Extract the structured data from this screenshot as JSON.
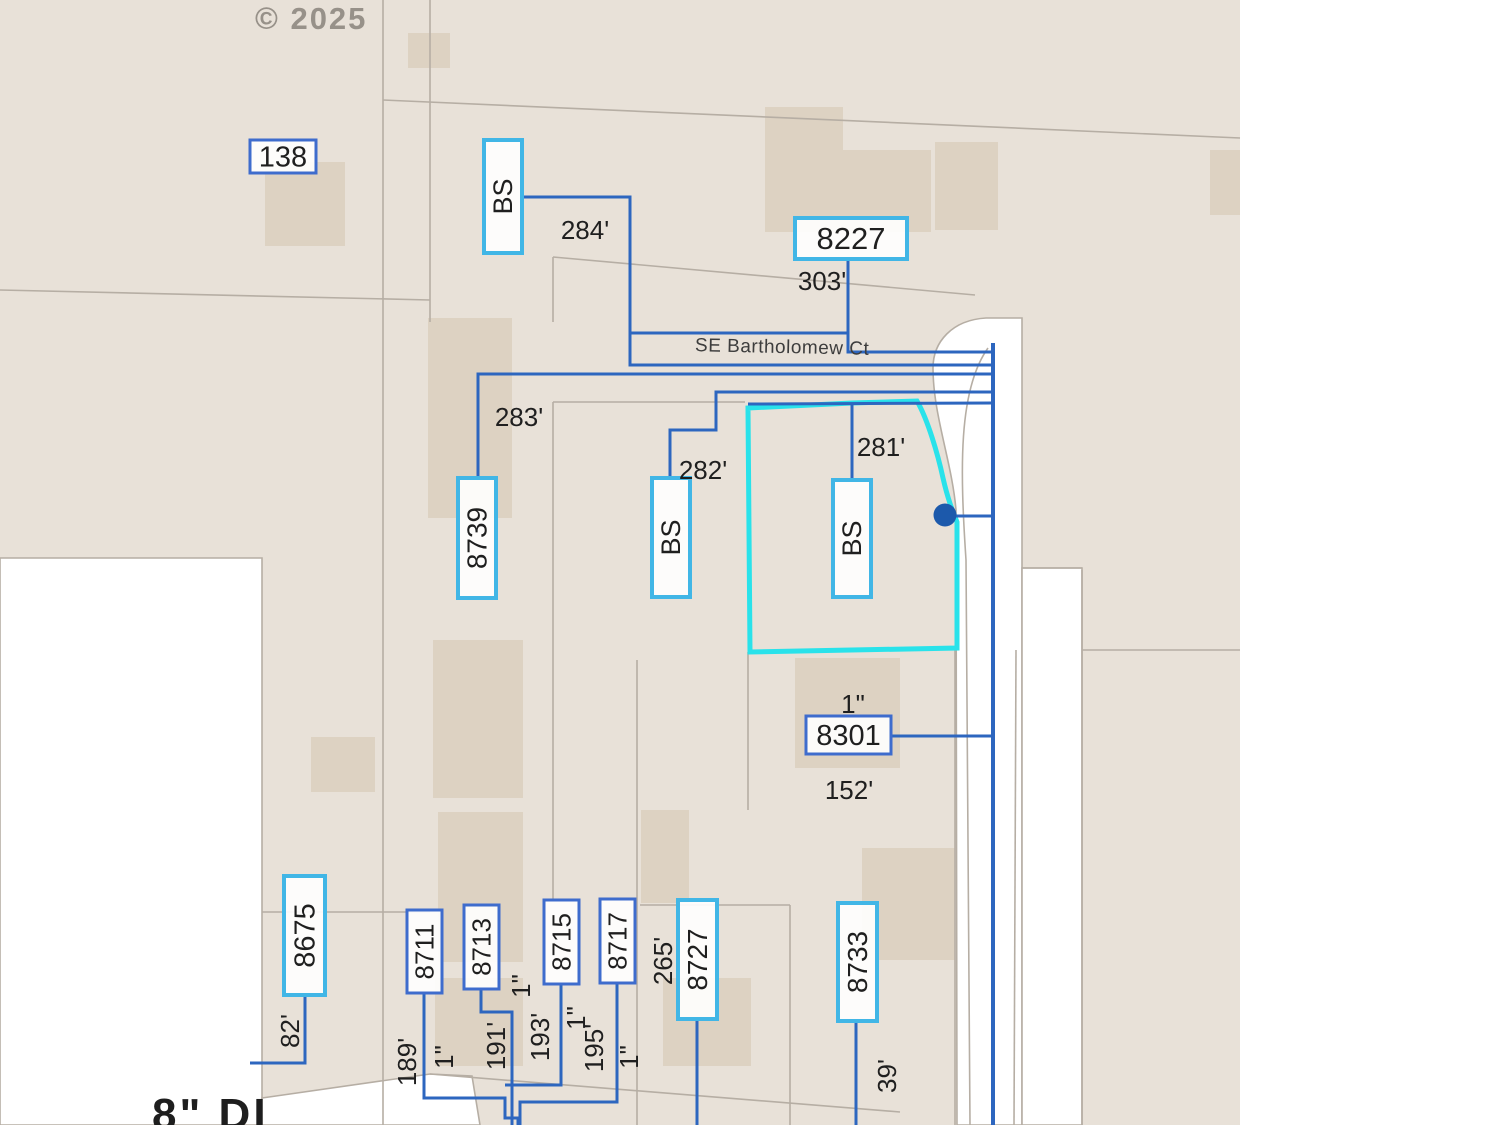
{
  "copyright": "© 2025",
  "street_name": "SE Bartholomew Ct",
  "bottom_note": "8\" DI",
  "colors": {
    "parcel_fill": "#e8e1d8",
    "building_fill": "#ddd2c2",
    "boundary_gray": "#b6aea4",
    "service_blue": "#2d66bf",
    "cyan_box_border": "#41b6e6",
    "blue_box_border": "#3e6ccd",
    "highlight_cyan": "#29e2ea",
    "dot_blue": "#1c59ab",
    "label_text": "#1f1f1f"
  },
  "map": {
    "base_rect": [
      0,
      0,
      1240,
      1125
    ],
    "white_areas": [
      {
        "name": "street-right-band",
        "d": "M 986 318 C 952 320 933 342 933 368 C 933 415 952 462 956 510 L 957 1125 L 1022 1125 L 1022 318 Z",
        "outlined": true
      },
      {
        "name": "street-right-notch",
        "d": "M 1022 568 L 1082 568 L 1082 1125 L 1022 1125 Z",
        "outlined": true
      },
      {
        "name": "open-area-left",
        "d": "M 0 558 L 262 558 L 262 1125 L 0 1125 Z",
        "outlined": true
      },
      {
        "name": "street-bottom-diagonal",
        "d": "M 262 1098 L 430 1074 L 472 1076 L 480 1125 L 262 1125 Z",
        "outlined": true
      },
      {
        "name": "map-edge-right",
        "d": "M 1240 0 L 1500 0 L 1500 1125 L 1240 1125 Z",
        "outlined": false
      }
    ],
    "curb_paths": [
      "M 988 348 C 958 390 960 470 966 560 L 970 1125",
      "M 1016 650 L 1014 1125"
    ],
    "buildings": [
      [
        265,
        162,
        80,
        84
      ],
      [
        408,
        33,
        42,
        35
      ],
      [
        765,
        107,
        78,
        125
      ],
      [
        843,
        150,
        88,
        82
      ],
      [
        935,
        142,
        63,
        88
      ],
      [
        428,
        318,
        84,
        200
      ],
      [
        311,
        737,
        64,
        55
      ],
      [
        433,
        640,
        90,
        158
      ],
      [
        438,
        812,
        85,
        150
      ],
      [
        435,
        978,
        88,
        88
      ],
      [
        641,
        810,
        48,
        93
      ],
      [
        795,
        658,
        105,
        110
      ],
      [
        862,
        848,
        93,
        112
      ],
      [
        663,
        978,
        88,
        88
      ],
      [
        1210,
        150,
        30,
        65
      ]
    ],
    "parcel_lines": [
      [
        [
          0,
          290
        ],
        [
          430,
          300
        ]
      ],
      [
        [
          383,
          0
        ],
        [
          383,
          1125
        ]
      ],
      [
        [
          430,
          0
        ],
        [
          430,
          322
        ]
      ],
      [
        [
          383,
          100
        ],
        [
          1240,
          138
        ]
      ],
      [
        [
          553,
          257
        ],
        [
          975,
          295
        ]
      ],
      [
        [
          553,
          257
        ],
        [
          553,
          322
        ]
      ],
      [
        [
          553,
          402
        ],
        [
          745,
          402
        ]
      ],
      [
        [
          553,
          402
        ],
        [
          553,
          900
        ]
      ],
      [
        [
          262,
          912
        ],
        [
          430,
          912
        ]
      ],
      [
        [
          637,
          660
        ],
        [
          637,
          1125
        ]
      ],
      [
        [
          748,
          652
        ],
        [
          748,
          810
        ]
      ],
      [
        [
          790,
          905
        ],
        [
          790,
          1125
        ]
      ],
      [
        [
          640,
          905
        ],
        [
          790,
          905
        ]
      ],
      [
        [
          955,
          650
        ],
        [
          955,
          1125
        ]
      ],
      [
        [
          1082,
          570
        ],
        [
          1082,
          1125
        ]
      ],
      [
        [
          1022,
          568
        ],
        [
          1082,
          568
        ]
      ],
      [
        [
          1082,
          650
        ],
        [
          1240,
          650
        ]
      ],
      [
        [
          430,
          1074
        ],
        [
          900,
          1112
        ]
      ]
    ],
    "highlight_parcel": {
      "name": "highlighted-parcel",
      "d": "M 748 408 L 852 403 L 917 401 C 928 420 938 455 943 478 C 948 500 953 512 957 522 L 957 648 L 750 652 Z"
    },
    "service_lines": [
      {
        "name": "service-line-284",
        "pts": [
          [
            523,
            197
          ],
          [
            630,
            197
          ],
          [
            630,
            365
          ],
          [
            993,
            365
          ]
        ]
      },
      {
        "name": "water-main-upper",
        "pts": [
          [
            630,
            333
          ],
          [
            848,
            333
          ],
          [
            848,
            352
          ],
          [
            993,
            352
          ]
        ]
      },
      {
        "name": "service-line-303",
        "pts": [
          [
            848,
            258
          ],
          [
            848,
            333
          ]
        ]
      },
      {
        "name": "service-line-283",
        "pts": [
          [
            478,
            480
          ],
          [
            478,
            374
          ],
          [
            993,
            374
          ]
        ]
      },
      {
        "name": "service-line-282",
        "pts": [
          [
            670,
            480
          ],
          [
            670,
            430
          ],
          [
            716,
            430
          ],
          [
            716,
            392
          ],
          [
            993,
            392
          ]
        ]
      },
      {
        "name": "service-line-281",
        "pts": [
          [
            748,
            404
          ],
          [
            993,
            403
          ]
        ]
      },
      {
        "name": "service-line-281-drop",
        "pts": [
          [
            852,
            404
          ],
          [
            852,
            482
          ]
        ]
      },
      {
        "name": "service-line-meter-dot",
        "pts": [
          [
            946,
            516
          ],
          [
            993,
            516
          ]
        ]
      },
      {
        "name": "service-line-8301",
        "pts": [
          [
            892,
            736
          ],
          [
            993,
            736
          ]
        ]
      },
      {
        "name": "service-line-8675",
        "pts": [
          [
            305,
            995
          ],
          [
            305,
            1063
          ],
          [
            250,
            1063
          ]
        ]
      },
      {
        "name": "service-line-8711",
        "pts": [
          [
            424,
            993
          ],
          [
            424,
            1098
          ],
          [
            505,
            1098
          ],
          [
            505,
            1118
          ],
          [
            518,
            1118
          ],
          [
            518,
            1125
          ]
        ]
      },
      {
        "name": "service-line-8713",
        "pts": [
          [
            481,
            989
          ],
          [
            481,
            1012
          ],
          [
            512,
            1012
          ],
          [
            512,
            1125
          ]
        ]
      },
      {
        "name": "service-line-8715",
        "pts": [
          [
            561,
            984
          ],
          [
            561,
            1085
          ],
          [
            505,
            1085
          ]
        ]
      },
      {
        "name": "service-line-8717",
        "pts": [
          [
            617,
            983
          ],
          [
            617,
            1102
          ],
          [
            520,
            1102
          ],
          [
            520,
            1125
          ]
        ]
      },
      {
        "name": "service-line-8727",
        "pts": [
          [
            697,
            1019
          ],
          [
            697,
            1125
          ]
        ]
      },
      {
        "name": "service-line-8733",
        "pts": [
          [
            856,
            1021
          ],
          [
            856,
            1125
          ]
        ]
      },
      {
        "name": "water-main-vertical",
        "pts": [
          [
            993,
            343
          ],
          [
            993,
            1125
          ]
        ],
        "w": 4
      }
    ],
    "dot": {
      "name": "service-point-dot",
      "cx": 945,
      "cy": 515,
      "r": 11.5
    },
    "label_boxes": [
      {
        "id": "138",
        "text": "138",
        "style": "blue",
        "orient": "h",
        "x": 250,
        "y": 140,
        "w": 66,
        "h": 33,
        "fs": 29
      },
      {
        "id": "bs-1",
        "text": "BS",
        "style": "cyan",
        "orient": "v",
        "x": 484,
        "y": 140,
        "w": 38,
        "h": 113,
        "fs": 27
      },
      {
        "id": "8227",
        "text": "8227",
        "style": "cyan",
        "orient": "h",
        "x": 795,
        "y": 218,
        "w": 112,
        "h": 41,
        "fs": 31
      },
      {
        "id": "8739",
        "text": "8739",
        "style": "cyan",
        "orient": "v",
        "x": 458,
        "y": 478,
        "w": 38,
        "h": 120,
        "fs": 28
      },
      {
        "id": "bs-2",
        "text": "BS",
        "style": "cyan",
        "orient": "v",
        "x": 652,
        "y": 478,
        "w": 38,
        "h": 119,
        "fs": 27
      },
      {
        "id": "bs-3",
        "text": "BS",
        "style": "cyan",
        "orient": "v",
        "x": 833,
        "y": 480,
        "w": 38,
        "h": 117,
        "fs": 27
      },
      {
        "id": "8301",
        "text": "8301",
        "style": "blue",
        "orient": "h",
        "x": 806,
        "y": 716,
        "w": 85,
        "h": 38,
        "fs": 29
      },
      {
        "id": "8675",
        "text": "8675",
        "style": "cyan",
        "orient": "v",
        "x": 284,
        "y": 876,
        "w": 41,
        "h": 119,
        "fs": 29
      },
      {
        "id": "8711",
        "text": "8711",
        "style": "blue",
        "orient": "v",
        "x": 407,
        "y": 910,
        "w": 35,
        "h": 83,
        "fs": 26
      },
      {
        "id": "8713",
        "text": "8713",
        "style": "blue",
        "orient": "v",
        "x": 464,
        "y": 905,
        "w": 35,
        "h": 84,
        "fs": 26
      },
      {
        "id": "8715",
        "text": "8715",
        "style": "blue",
        "orient": "v",
        "x": 544,
        "y": 900,
        "w": 35,
        "h": 84,
        "fs": 26
      },
      {
        "id": "8717",
        "text": "8717",
        "style": "blue",
        "orient": "v",
        "x": 600,
        "y": 899,
        "w": 35,
        "h": 84,
        "fs": 26
      },
      {
        "id": "8727",
        "text": "8727",
        "style": "cyan",
        "orient": "v",
        "x": 678,
        "y": 900,
        "w": 39,
        "h": 119,
        "fs": 28
      },
      {
        "id": "8733",
        "text": "8733",
        "style": "cyan",
        "orient": "v",
        "x": 838,
        "y": 903,
        "w": 39,
        "h": 118,
        "fs": 28
      }
    ],
    "measurements": [
      {
        "text": "284'",
        "orient": "h",
        "x": 585,
        "y": 230
      },
      {
        "text": "303'",
        "orient": "h",
        "x": 822,
        "y": 281
      },
      {
        "text": "283'",
        "orient": "h",
        "x": 519,
        "y": 417
      },
      {
        "text": "282'",
        "orient": "h",
        "x": 703,
        "y": 470
      },
      {
        "text": "281'",
        "orient": "h",
        "x": 881,
        "y": 447
      },
      {
        "text": "1\"",
        "orient": "h",
        "x": 853,
        "y": 704
      },
      {
        "text": "152'",
        "orient": "h",
        "x": 849,
        "y": 790
      },
      {
        "text": "82'",
        "orient": "v",
        "x": 290,
        "y": 1031
      },
      {
        "text": "189'",
        "orient": "v",
        "x": 407,
        "y": 1062
      },
      {
        "text": "1\"",
        "orient": "v",
        "x": 444,
        "y": 1057
      },
      {
        "text": "191'",
        "orient": "v",
        "x": 496,
        "y": 1046
      },
      {
        "text": "1\"",
        "orient": "v",
        "x": 521,
        "y": 986
      },
      {
        "text": "193'",
        "orient": "v",
        "x": 540,
        "y": 1037
      },
      {
        "text": "1\"",
        "orient": "v",
        "x": 576,
        "y": 1018
      },
      {
        "text": "195'",
        "orient": "v",
        "x": 594,
        "y": 1048
      },
      {
        "text": "1\"",
        "orient": "v",
        "x": 629,
        "y": 1057
      },
      {
        "text": "265'",
        "orient": "v",
        "x": 663,
        "y": 961
      },
      {
        "text": "39'",
        "orient": "v",
        "x": 887,
        "y": 1076
      }
    ]
  }
}
